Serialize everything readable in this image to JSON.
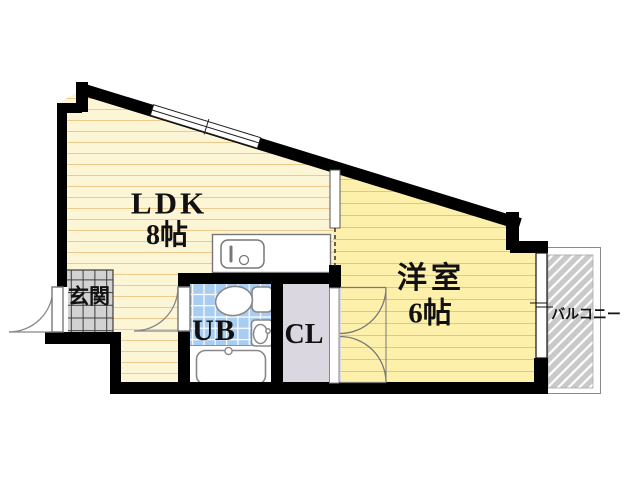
{
  "plan": {
    "type": "apartment-floor-plan",
    "rooms": {
      "ldk": {
        "label": "LDK",
        "size": "8帖"
      },
      "western": {
        "label": "洋室",
        "size": "6帖"
      },
      "entrance": {
        "label": "玄関"
      },
      "unit_bath": {
        "label": "UB"
      },
      "closet": {
        "label": "CL"
      },
      "balcony": {
        "label": "バルコニー"
      }
    },
    "colors": {
      "wall": "#000000",
      "ldk_floor": "#fcf5d6",
      "ldk_stripe": "#f0c98c",
      "western_floor": "#fdf0ab",
      "western_stripe": "#edc177",
      "bath_tile": "#a9ccf1",
      "entrance_tile": "#d2d2d2",
      "closet_fill": "#dad7e0",
      "balcony_fill": "#c9c9c9",
      "fixture_line": "#808080"
    }
  }
}
